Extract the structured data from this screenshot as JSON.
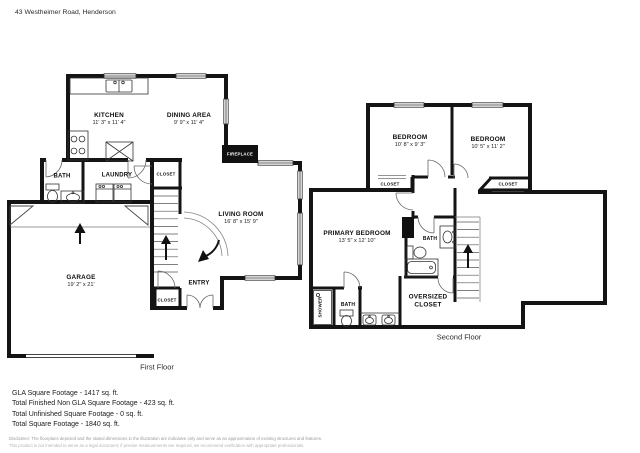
{
  "header": {
    "address": "43 Westheimer Road, Henderson"
  },
  "first_floor": {
    "title": "First Floor",
    "rooms": {
      "kitchen": {
        "label": "KITCHEN",
        "dims": "11' 3\" x 11' 4\""
      },
      "dining": {
        "label": "DINING AREA",
        "dims": "9' 9\" x 11' 4\""
      },
      "living": {
        "label": "LIVING ROOM",
        "dims": "16' 8\" x 15' 9\""
      },
      "garage": {
        "label": "GARAGE",
        "dims": "19' 2\" x 21'"
      },
      "fireplace": {
        "label": "FIREPLACE"
      },
      "bath": {
        "label": "BATH"
      },
      "laundry": {
        "label": "LAUNDRY"
      },
      "entry": {
        "label": "ENTRY"
      },
      "closet_upper": {
        "label": "CLOSET"
      },
      "closet_lower": {
        "label": "CLOSET"
      }
    }
  },
  "second_floor": {
    "title": "Second Floor",
    "rooms": {
      "bedroom_left": {
        "label": "BEDROOM",
        "dims": "10' 8\" x 9' 3\""
      },
      "bedroom_right": {
        "label": "BEDROOM",
        "dims": "10' 5\" x 11' 2\""
      },
      "primary_bedroom": {
        "label": "PRIMARY BEDROOM",
        "dims": "13' 5\" x 12' 10\""
      },
      "bath": {
        "label": "BATH"
      },
      "bath_lower": {
        "label": "BATH"
      },
      "shower": {
        "label": "SHOWER"
      },
      "closet_left": {
        "label": "CLOSET"
      },
      "closet_right": {
        "label": "CLOSET"
      },
      "oversized_closet": {
        "label_line1": "OVERSIZED",
        "label_line2": "CLOSET"
      }
    }
  },
  "footer": {
    "stats": [
      "GLA Square Footage - 1417 sq. ft.",
      "Total Finished Non GLA Square Footage - 423 sq. ft.",
      "Total Unfinished Square Footage - 0 sq. ft.",
      "Total Square Footage - 1840 sq. ft."
    ],
    "disclaimer_line1": "Disclaimer: The floorplans depicted and the stated dimensions in the illustration are indicative only and serve as an approximation of existing structures and features.",
    "disclaimer_line2": "This product is not intended to serve as a legal document; if precise measurements are required, we recommend verification with appropriate professionals."
  }
}
